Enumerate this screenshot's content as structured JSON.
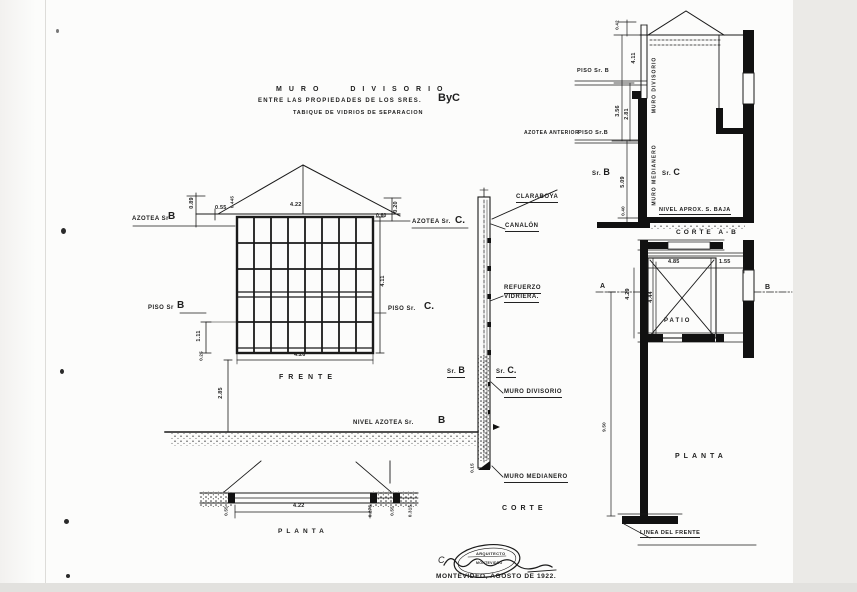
{
  "page": {
    "paper_color": "#fcfcfb",
    "ink_color": "#1c1c1c",
    "edge_color": "#ebeae7"
  },
  "title": {
    "line1": "MURO DIVISORIO",
    "line2": "ENTRE LAS PROPIEDADES DE LOS SRES.",
    "owners": "ByC",
    "line3": "TABIQUE DE VIDRIOS DE SEPARACION"
  },
  "frente": {
    "label": "FRENTE",
    "dim_top": "4.22",
    "dim_bottom": "4.26",
    "dim_right": "4.11",
    "dim_089": "0.89",
    "dim_055": "0.55",
    "dim_0445": "0.445",
    "dim_060": "0.60",
    "dim_020": "0.20",
    "dim_111": "1.11",
    "dim_025": "0.25",
    "dim_285": "2.85",
    "azotea_l": "AZOTEA Sr",
    "azotea_l_letter": "B",
    "azotea_r": "AZOTEA Sr.",
    "azotea_r_letter": "C.",
    "piso_l": "PISO Sr",
    "piso_l_letter": "B",
    "piso_r": "PISO Sr.",
    "piso_r_letter": "C.",
    "nivel": "NIVEL AZOTEA Sr.",
    "nivel_letter": "B"
  },
  "corte": {
    "label": "CORTE",
    "claraboya": "CLARABOYA",
    "canalon": "CANALÓN",
    "refuerzo_1": "REFUERZO",
    "refuerzo_2": "VIDRIERA.",
    "sr_b": "Sr.",
    "sr_b_letter": "B",
    "sr_c": "Sr.",
    "sr_c_letter": "C.",
    "muro_divisorio": "MURO DIVISORIO",
    "muro_medianero": "MURO MEDIANERO",
    "dim_015": "0.15"
  },
  "corte_ab": {
    "label": "CORTE A-B",
    "dim_042": "0.42",
    "dim_411": "4.11",
    "dim_356": "3.56",
    "dim_281": "2.81",
    "dim_509": "5.09",
    "dim_040": "0.40",
    "piso_b": "PISO Sr. B",
    "azotea_ant": "AZOTEA ANTERIOR",
    "piso_b2": "PISO Sr.B",
    "muro_divisorio": "MURO DIVISORIO",
    "muro_medianero": "MURO MEDIANERO",
    "sr_b": "Sr.",
    "sr_b_letter": "B",
    "sr_c": "Sr.",
    "sr_c_letter": "C",
    "nivel": "NIVEL APROX. S. BAJA"
  },
  "planta_right": {
    "label": "PLANTA",
    "patio": "PATIO",
    "dim_485": "4.85",
    "dim_155": "1.55",
    "dim_429": "4.29",
    "dim_444": "4.44",
    "dim_950": "9.50",
    "marker_a": "A",
    "marker_b": "B",
    "linea": "LINEA DEL FRENTE"
  },
  "planta_left": {
    "label": "PLANTA",
    "dim_422": "4.22",
    "dim_l_055": "0.55",
    "dim_r_0275": "0.275",
    "dim_r_055": "0.55",
    "dim_r_0315": "0.315"
  },
  "stamp": {
    "signature": "C.",
    "seal_1": "ARQUITECTO",
    "seal_2": "MONTEVIDEO",
    "date": "MONTEVIDEO, AGOSTO DE 1922."
  }
}
